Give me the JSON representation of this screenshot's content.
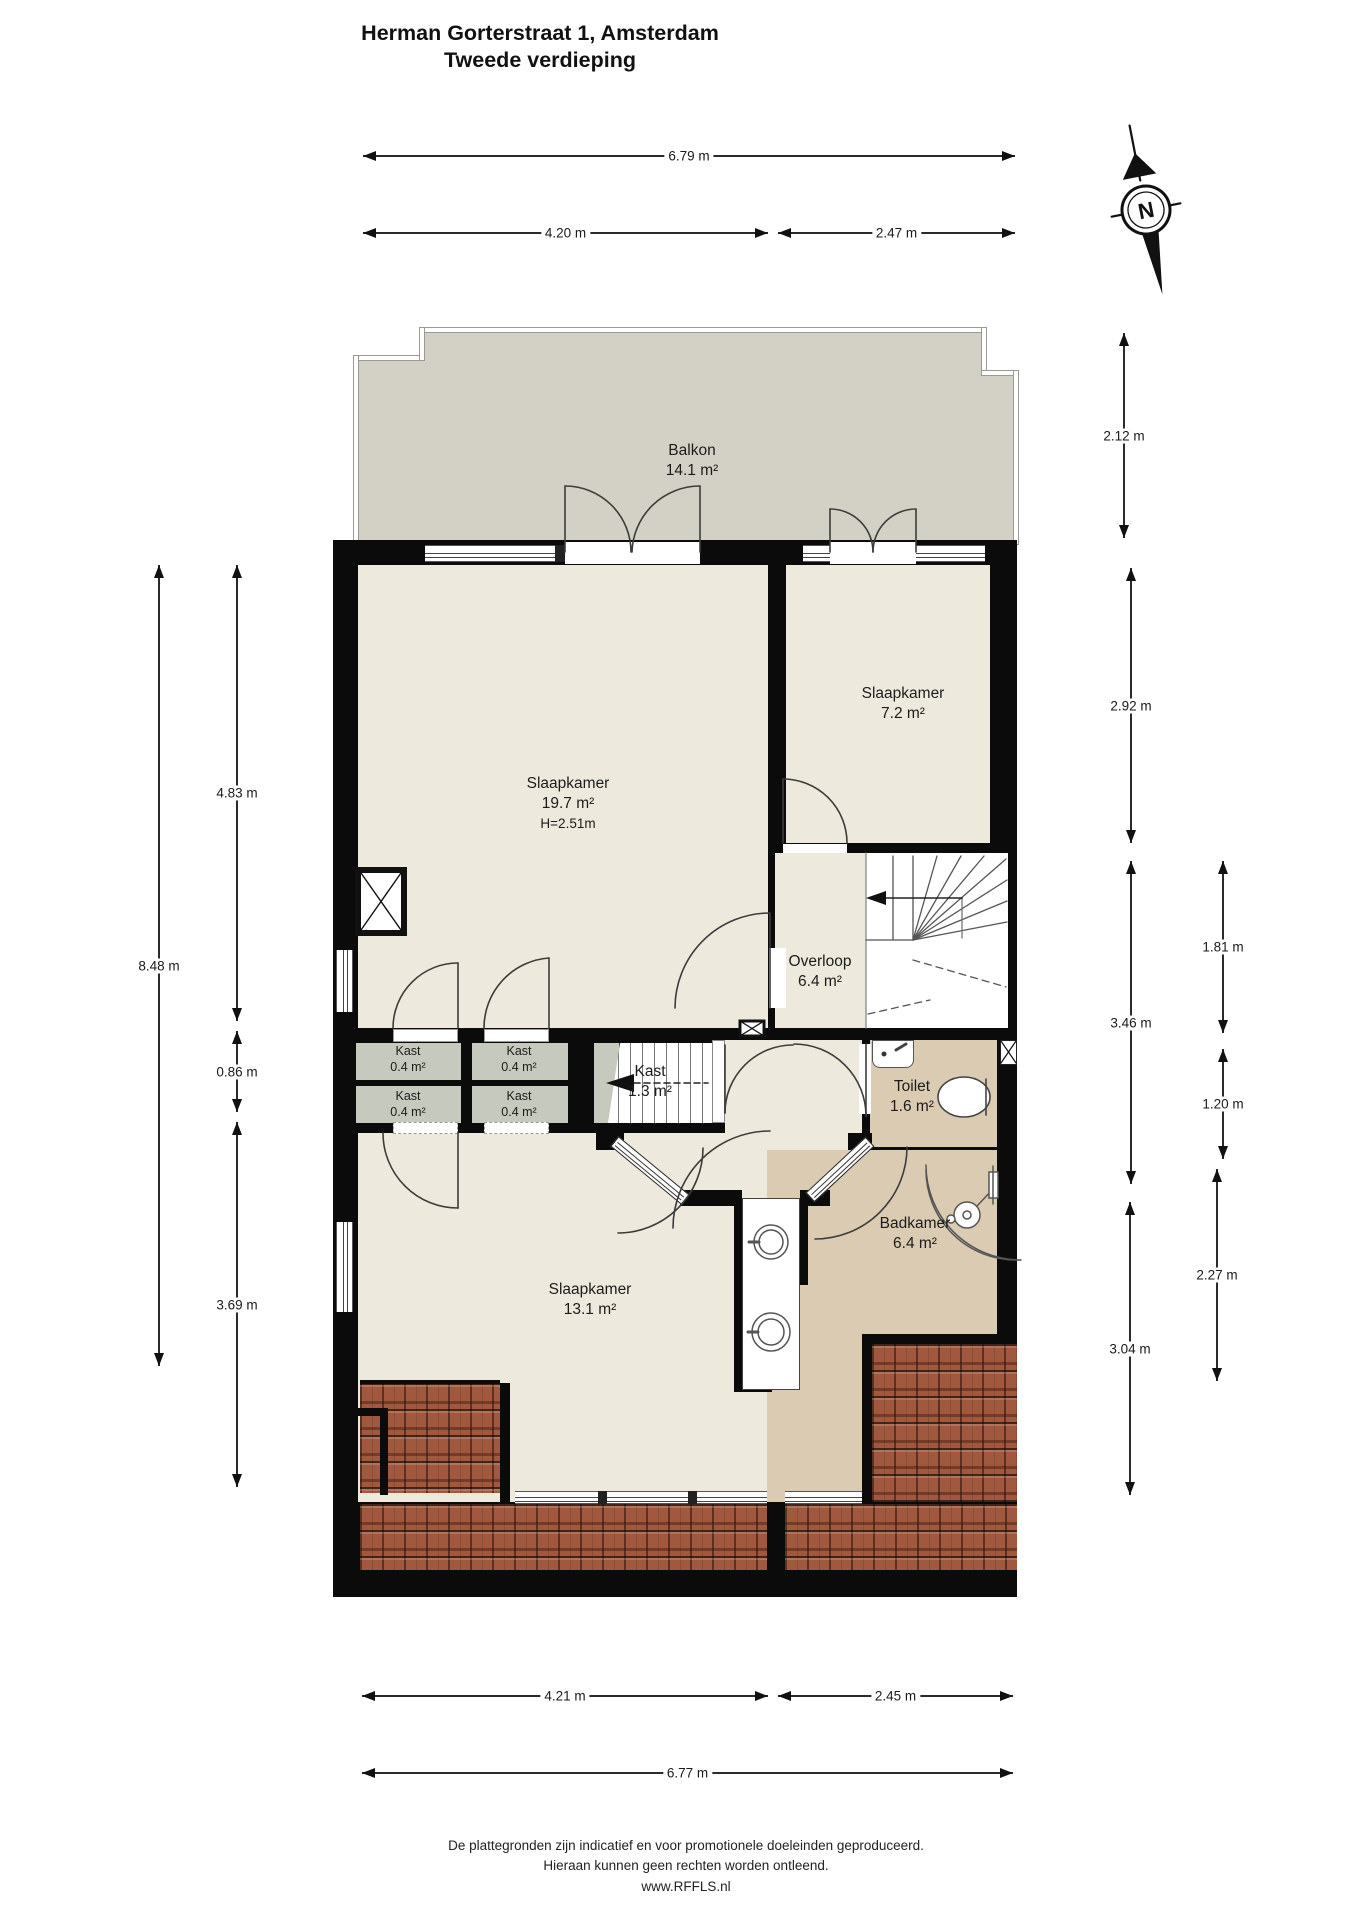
{
  "title": {
    "line1": "Herman Gorterstraat 1, Amsterdam",
    "line2": "Tweede verdieping"
  },
  "compass": {
    "north_label": "N"
  },
  "rooms": [
    {
      "id": "balkon",
      "name": "Balkon",
      "area": "14.1 m²",
      "extra": "",
      "x": 692,
      "y": 441,
      "small": false
    },
    {
      "id": "slaapkamer-19",
      "name": "Slaapkamer",
      "area": "19.7 m²",
      "extra": "H=2.51m",
      "x": 568,
      "y": 774,
      "small": false
    },
    {
      "id": "slaapkamer-7",
      "name": "Slaapkamer",
      "area": "7.2 m²",
      "extra": "",
      "x": 903,
      "y": 684,
      "small": false
    },
    {
      "id": "overloop",
      "name": "Overloop",
      "area": "6.4 m²",
      "extra": "",
      "x": 820,
      "y": 952,
      "small": false
    },
    {
      "id": "kast-13",
      "name": "Kast",
      "area": "1.3 m²",
      "extra": "",
      "x": 650,
      "y": 1062,
      "small": false
    },
    {
      "id": "toilet",
      "name": "Toilet",
      "area": "1.6 m²",
      "extra": "",
      "x": 912,
      "y": 1077,
      "small": false
    },
    {
      "id": "slaapkamer-13",
      "name": "Slaapkamer",
      "area": "13.1 m²",
      "extra": "",
      "x": 590,
      "y": 1280,
      "small": false
    },
    {
      "id": "badkamer",
      "name": "Badkamer",
      "area": "6.4 m²",
      "extra": "",
      "x": 915,
      "y": 1214,
      "small": false
    },
    {
      "id": "kast-a",
      "name": "Kast",
      "area": "0.4 m²",
      "extra": "",
      "x": 408,
      "y": 1044,
      "small": true
    },
    {
      "id": "kast-b",
      "name": "Kast",
      "area": "0.4 m²",
      "extra": "",
      "x": 519,
      "y": 1044,
      "small": true
    },
    {
      "id": "kast-c",
      "name": "Kast",
      "area": "0.4 m²",
      "extra": "",
      "x": 408,
      "y": 1089,
      "small": true
    },
    {
      "id": "kast-d",
      "name": "Kast",
      "area": "0.4 m²",
      "extra": "",
      "x": 519,
      "y": 1089,
      "small": true
    }
  ],
  "dimensions_horizontal": [
    {
      "label": "6.79 m",
      "x1": 363,
      "x2": 1015,
      "y": 155
    },
    {
      "label": "4.20 m",
      "x1": 363,
      "x2": 768,
      "y": 232
    },
    {
      "label": "2.47 m",
      "x1": 778,
      "x2": 1015,
      "y": 232
    },
    {
      "label": "4.21 m",
      "x1": 362,
      "x2": 768,
      "y": 1695
    },
    {
      "label": "2.45 m",
      "x1": 778,
      "x2": 1013,
      "y": 1695
    },
    {
      "label": "6.77 m",
      "x1": 362,
      "x2": 1013,
      "y": 1772
    }
  ],
  "dimensions_vertical": [
    {
      "label": "8.48 m",
      "x": 158,
      "y1": 565,
      "y2": 1366
    },
    {
      "label": "4.83 m",
      "x": 236,
      "y1": 565,
      "y2": 1021
    },
    {
      "label": "0.86 m",
      "x": 236,
      "y1": 1031,
      "y2": 1112
    },
    {
      "label": "3.69 m",
      "x": 236,
      "y1": 1122,
      "y2": 1487
    },
    {
      "label": "2.12 m",
      "x": 1123,
      "y1": 333,
      "y2": 538
    },
    {
      "label": "2.92 m",
      "x": 1130,
      "y1": 568,
      "y2": 843
    },
    {
      "label": "3.46 m",
      "x": 1130,
      "y1": 861,
      "y2": 1184
    },
    {
      "label": "3.04 m",
      "x": 1129,
      "y1": 1202,
      "y2": 1495
    },
    {
      "label": "1.81 m",
      "x": 1222,
      "y1": 861,
      "y2": 1033
    },
    {
      "label": "1.20 m",
      "x": 1222,
      "y1": 1049,
      "y2": 1159
    },
    {
      "label": "2.27 m",
      "x": 1216,
      "y1": 1169,
      "y2": 1381
    }
  ],
  "footer": {
    "line1": "De plattegronden zijn indicatief en voor promotionele doeleinden geproduceerd.",
    "line2": "Hieraan kunnen geen rechten worden ontleend.",
    "line3": "www.RFFLS.nl"
  },
  "colors": {
    "wall": "#0b0b0b",
    "floor": "#ede9dc",
    "balcony": "#d3d0c5",
    "closet": "#c6c9bd",
    "sanitary": "#dacbb2",
    "roof_tiles": "#a0593f"
  }
}
